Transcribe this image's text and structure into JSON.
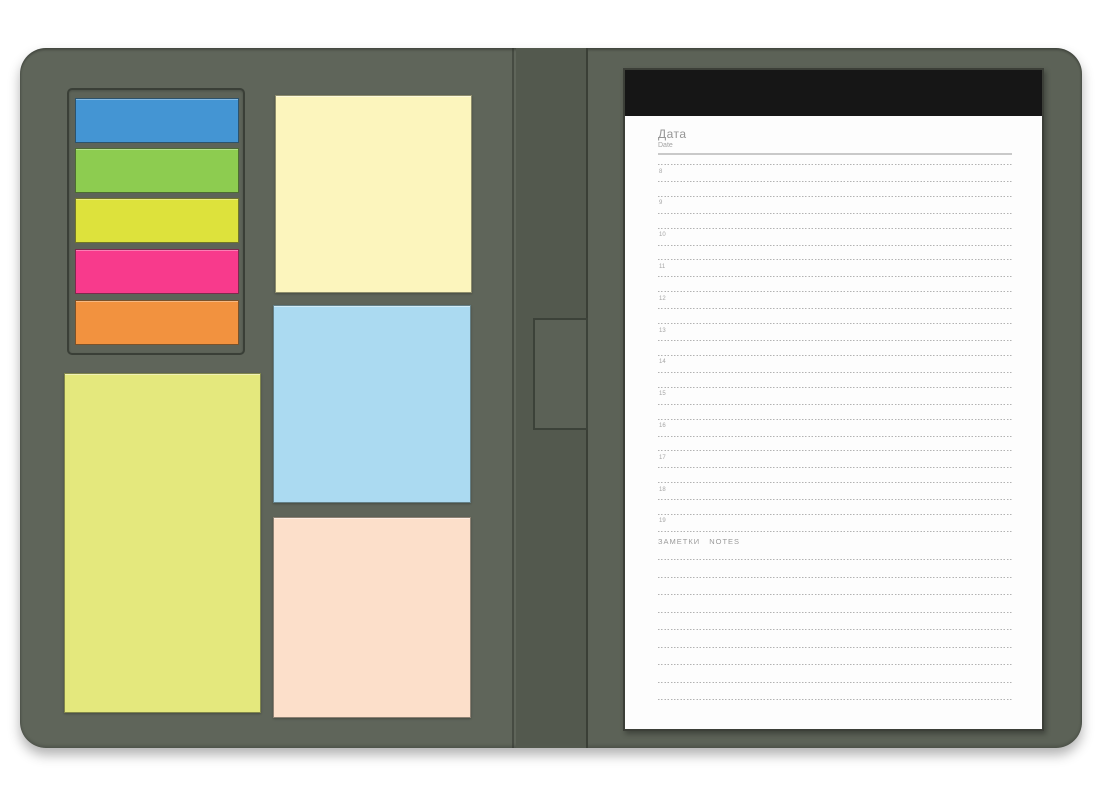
{
  "folder": {
    "cover_color_left": "#5f655a",
    "cover_color_right": "#5c6257",
    "spine_color": "#53594e",
    "pen_slot_color": "#5b6156"
  },
  "sticky_flags": [
    {
      "name": "blue",
      "color": "#4495d3"
    },
    {
      "name": "green",
      "color": "#8dcc50"
    },
    {
      "name": "lime",
      "color": "#dde23c"
    },
    {
      "name": "pink",
      "color": "#f83a8c"
    },
    {
      "name": "orange",
      "color": "#f2923f"
    }
  ],
  "sticky_notes": [
    {
      "name": "large-lime-pad",
      "color": "#e4e87d"
    },
    {
      "name": "pale-yellow",
      "color": "#fcf5bd"
    },
    {
      "name": "light-blue",
      "color": "#abdaf1"
    },
    {
      "name": "peach",
      "color": "#fcdfca"
    }
  ],
  "notepad": {
    "header_color": "#161616",
    "page_color": "#fdfdfd",
    "date_label_ru": "Дата",
    "date_label_en": "Date",
    "hours": [
      "8",
      "9",
      "10",
      "11",
      "12",
      "13",
      "14",
      "15",
      "16",
      "17",
      "18",
      "19"
    ],
    "notes_label": "ЗАМЕТКИ NOTES",
    "notes_lines": 9
  }
}
